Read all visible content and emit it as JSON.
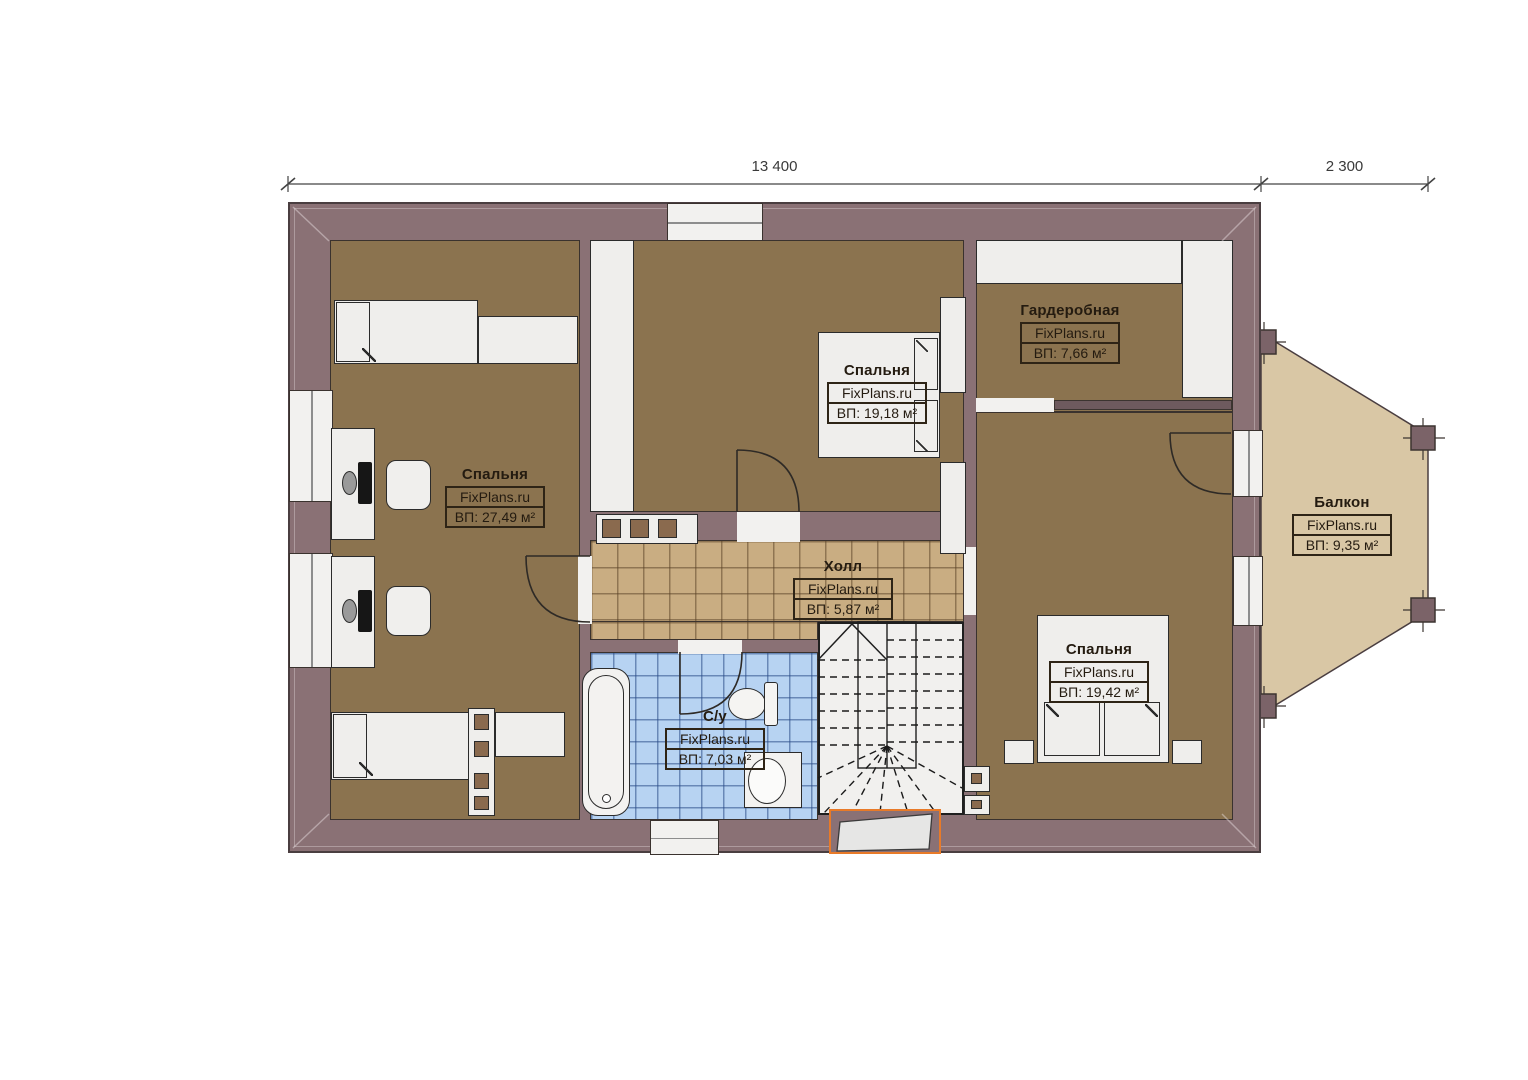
{
  "plan": {
    "title": "Floor plan (second floor)",
    "dimensions": [
      {
        "label": "13 400"
      },
      {
        "label": "2 300"
      }
    ],
    "rooms": [
      {
        "name": "Спальня",
        "brand": "FixPlans.ru",
        "area": "ВП: 27,49 м²"
      },
      {
        "name": "Спальня",
        "brand": "FixPlans.ru",
        "area": "ВП: 19,18 м²"
      },
      {
        "name": "Гардеробная",
        "brand": "FixPlans.ru",
        "area": "ВП: 7,66 м²"
      },
      {
        "name": "Холл",
        "brand": "FixPlans.ru",
        "area": "ВП: 5,87 м²"
      },
      {
        "name": "С/у",
        "brand": "FixPlans.ru",
        "area": "ВП: 7,03 м²"
      },
      {
        "name": "Спальня",
        "brand": "FixPlans.ru",
        "area": "ВП: 19,42 м²"
      },
      {
        "name": "Балкон",
        "brand": "FixPlans.ru",
        "area": "ВП: 9,35 м²"
      }
    ],
    "colors": {
      "wall": "#8a7175",
      "room_floor": "#8b734f",
      "hall_tile": "#c9ad82",
      "bath_tile": "#b7d3f2",
      "balcony_floor": "#d9c7a5",
      "skylight_accent": "#e87a28",
      "furniture": "#efeeec"
    }
  }
}
